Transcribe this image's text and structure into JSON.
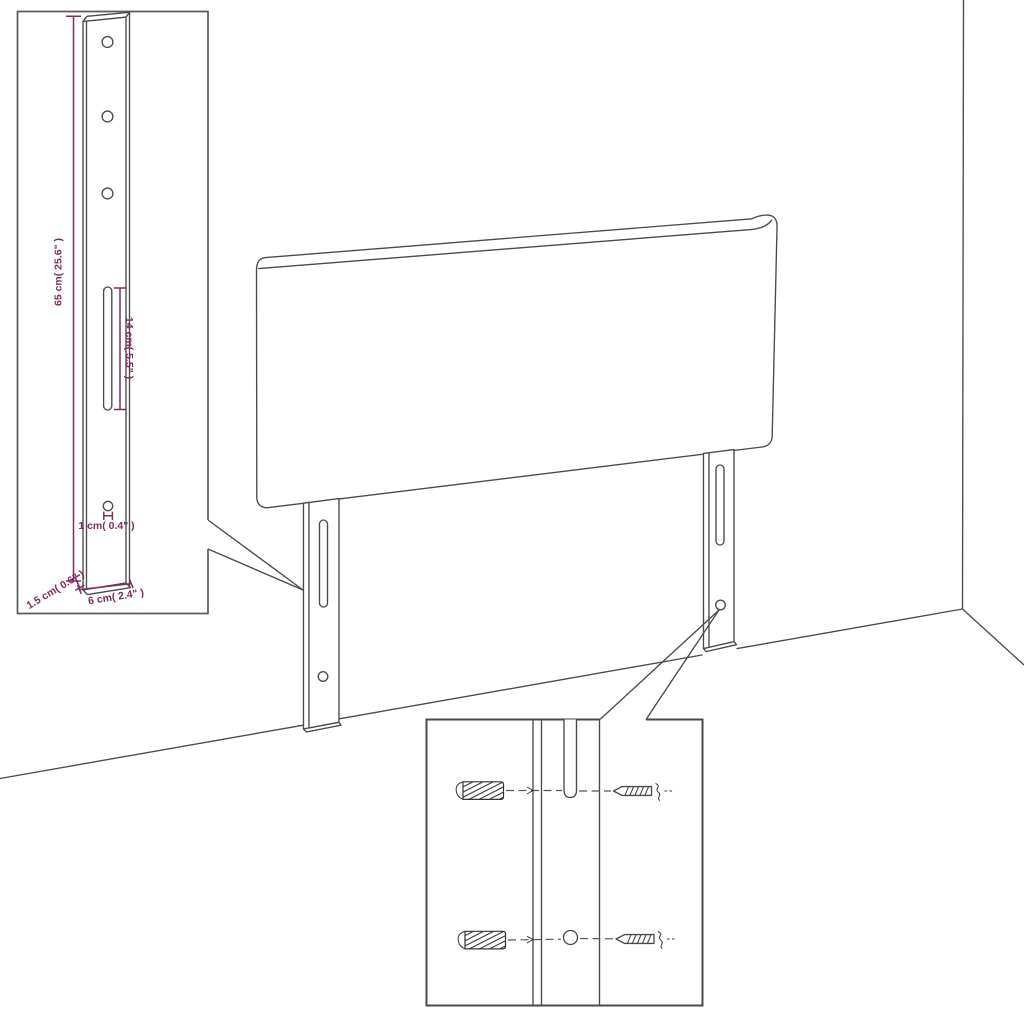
{
  "diagram": {
    "type": "furniture dimension and assembly diagram",
    "subject": "headboard panel with two mounting legs shown in a room corner",
    "colors": {
      "background": "#ffffff",
      "line_art": "#4a4a4a",
      "dimension_accent": "#7d2d5e",
      "inset_border": "#5a5a5a"
    },
    "bracket_inset": {
      "dimensions": {
        "leg_height": "65 cm( 25.6\" )",
        "slot_length": "14 cm( 5.5\" )",
        "hole_diameter": "1 cm( 0.4\" )",
        "leg_depth": "1.5 cm( 0.6\" )",
        "leg_width": "6 cm( 2.4\" )"
      }
    },
    "hardware_inset": {
      "icons": [
        "wall-plug-icon",
        "screw-icon",
        "wall-plug-icon",
        "screw-icon"
      ]
    }
  }
}
